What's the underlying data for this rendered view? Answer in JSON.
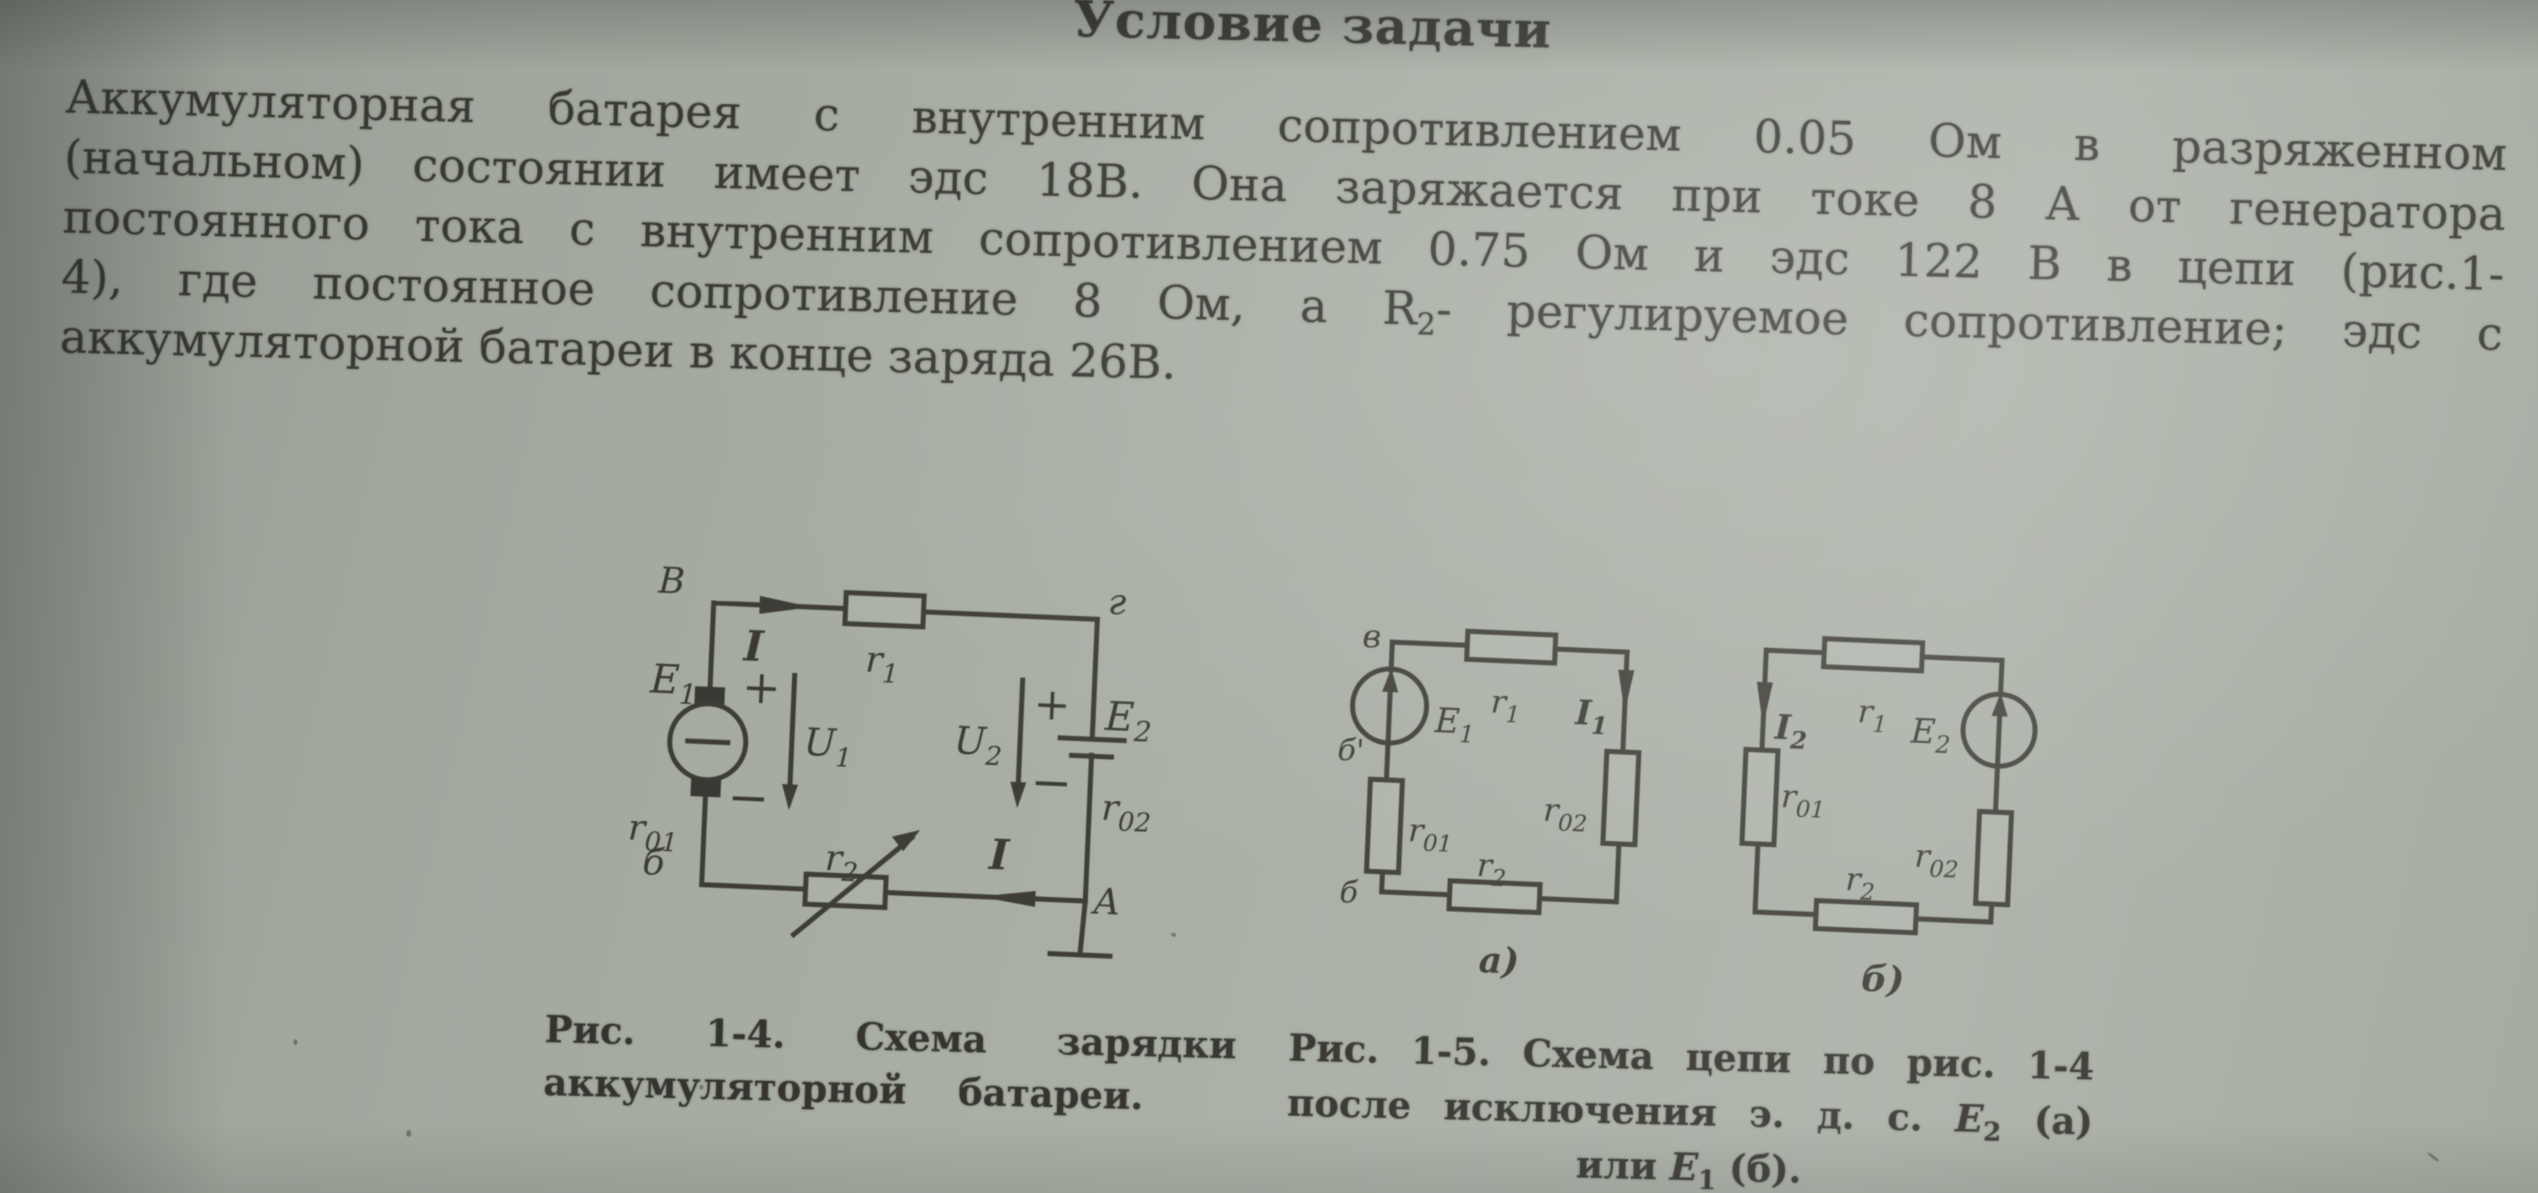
{
  "colors": {
    "ink": "#3b3a33",
    "paper": "#a9afa5"
  },
  "title": "Условие задачи",
  "paragraph": {
    "line1": "Аккумуляторная батарея с внутренним сопротивлением 0.05 Ом в разряженном",
    "line2": "(начальном) состоянии имеет эдс 18В. Она заряжается при токе 8 А от генератора",
    "line3": "постоянного тока с внутренним сопротивлением 0.75 Ом и эдс 122 В в цепи (рис.1-",
    "line4_pre": "4), где постоянное сопротивление 8 Ом, а R",
    "line4_sub": "2",
    "line4_post": "- регулируемое сопротивление; эдс с",
    "line5": "аккумуляторной батареи в конце заряда 26В."
  },
  "fig14": {
    "caption_line1": "Рис. 1-4. Схема зарядки",
    "caption_line2": "аккумуляторной батареи.",
    "node_tl": "В",
    "node_tr": "г",
    "node_bl": "б",
    "node_br": "А",
    "current": "I",
    "plus": "+",
    "minus": "−",
    "emf1": {
      "main": "E",
      "sub": "1"
    },
    "emf2": {
      "main": "E",
      "sub": "2"
    },
    "u1": {
      "main": "U",
      "sub": "1"
    },
    "u2": {
      "main": "U",
      "sub": "2"
    },
    "r1": {
      "main": "r",
      "sub": "1"
    },
    "r2": {
      "main": "r",
      "sub": "2"
    },
    "r01": {
      "main": "r",
      "sub": "01"
    },
    "r02": {
      "main": "r",
      "sub": "02"
    }
  },
  "fig15a": {
    "label": "а)",
    "node_tl": "в",
    "node_mid": "б'",
    "node_bl": "б",
    "emf1": {
      "main": "E",
      "sub": "1"
    },
    "i1": {
      "main": "I",
      "sub": "1"
    },
    "r1": {
      "main": "r",
      "sub": "1"
    },
    "r2": {
      "main": "r",
      "sub": "2"
    },
    "r01": {
      "main": "r",
      "sub": "01"
    },
    "r02": {
      "main": "r",
      "sub": "02"
    }
  },
  "fig15b": {
    "label": "б)",
    "emf2": {
      "main": "E",
      "sub": "2"
    },
    "i2": {
      "main": "I",
      "sub": "2"
    },
    "r1": {
      "main": "r",
      "sub": "1"
    },
    "r2": {
      "main": "r",
      "sub": "2"
    },
    "r01": {
      "main": "r",
      "sub": "01"
    },
    "r02": {
      "main": "r",
      "sub": "02"
    }
  },
  "fig15_caption": {
    "line1": "Рис. 1-5. Схема цепи по рис. 1-4",
    "line2_pre": "после исключения э. д. с. ",
    "line2_emf": "E",
    "line2_sub": "2",
    "line2_post": " (а)",
    "line3_pre": "или ",
    "line3_emf": "E",
    "line3_sub": "1",
    "line3_post": " (б)."
  }
}
